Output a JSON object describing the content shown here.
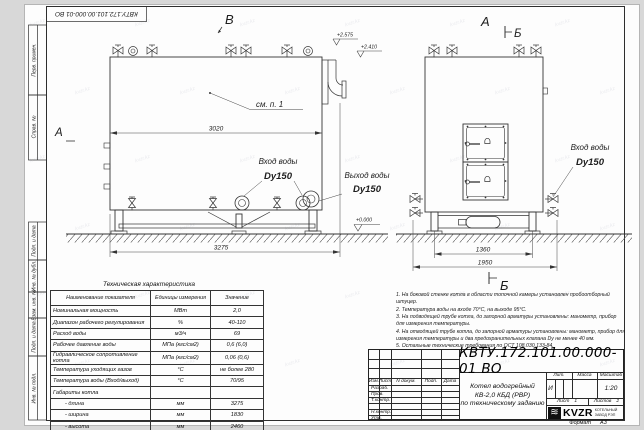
{
  "doc": {
    "number": "КВТУ.172.101.00.000-01 ВО",
    "format_label": "Формат",
    "format_value": "А3"
  },
  "frame_stamps": {
    "labels": [
      "Перв. примен.",
      "Справ. №",
      "Подп. и дата",
      "Инв. № дубл.",
      "Взам. инв. №",
      "Подп. и дата",
      "Инв. № подл."
    ]
  },
  "views": {
    "view_b": "В",
    "view_a_top": "А",
    "section_b_top": "Б",
    "view_a_left": "А",
    "section_b_bottom": "Б",
    "see_note": "см. п. 1",
    "water_in": "Вход воды",
    "water_out": "Выход воды",
    "dn": "Dy150",
    "elev_1": "+2.575",
    "elev_2": "+2.410",
    "elev_0": "+0.000",
    "dim_3020": "3020",
    "dim_3275": "3275",
    "dim_1360": "1360",
    "dim_1950": "1950"
  },
  "tech_table": {
    "title": "Техническая характеристика",
    "headers": [
      "Наименование показателя",
      "Единицы измерения",
      "Значение"
    ],
    "rows": [
      [
        "Номинальная мощность",
        "МВт",
        "2,0"
      ],
      [
        "Диапазон рабочего регулирования",
        "%",
        "40-110"
      ],
      [
        "Расход воды",
        "м3/ч",
        "69"
      ],
      [
        "Рабочее давление воды",
        "МПа (кгс/см2)",
        "0,6 (6,0)"
      ],
      [
        "Гидравлическое сопротивление котла",
        "МПа (кгс/см2)",
        "0,06 (0,6)"
      ],
      [
        "Температура уходящих газов",
        "°С",
        "не более 280"
      ],
      [
        "Температура воды (Вход/выход)",
        "°С",
        "70/95"
      ],
      [
        "Габариты котла",
        "",
        ""
      ],
      [
        "- длина",
        "мм",
        "3275"
      ],
      [
        "- ширина",
        "мм",
        "1830"
      ],
      [
        "- высота",
        "мм",
        "2460"
      ]
    ]
  },
  "notes": {
    "lines": [
      "1.  На боковой стенке котла в области топочной камеры установлен пробоотборный штуцер.",
      "2.  Температура воды на входе 70°С, на выходе 95°С.",
      "3.  На подводящей трубе котла, до запорной арматуры установлены: манометр, прибор для измерения температуры.",
      "4.  На отводящей трубе котла, до запорной арматуры установлены: манометр, прибор для измерения температуры и два предохранительных клапана  Dу не менее 40 мм.",
      "5.  Остальные технические требования по ОСТ 108.030.133-84."
    ]
  },
  "title_block": {
    "cols": [
      "Изм.",
      "Лист",
      "N докум.",
      "Подп.",
      "Дата"
    ],
    "rows": [
      "Разраб.",
      "Пров.",
      "Т.контр.",
      "Н.контр.",
      "Утв."
    ],
    "product_line1": "Котел водогрейный",
    "product_line2": "КВ-2,0 КБД (РВР)",
    "product_line3": "по техническому заданию",
    "lit_label": "Лит.",
    "lit_value": "И",
    "mass_label": "Масса",
    "scale_label": "Масштаб",
    "scale_value": "1:20",
    "sheet_label": "Лист",
    "sheet_value": "1",
    "sheets_label": "Листов",
    "sheets_value": "2",
    "company": "KVZR",
    "company_sub1": "КОТЕЛЬНЫЙ",
    "company_sub2": "ЗАВОД РЭП"
  },
  "watermark": {
    "text": "kvzr.kz"
  },
  "icons": {
    "kvzr_logo": "≋"
  }
}
